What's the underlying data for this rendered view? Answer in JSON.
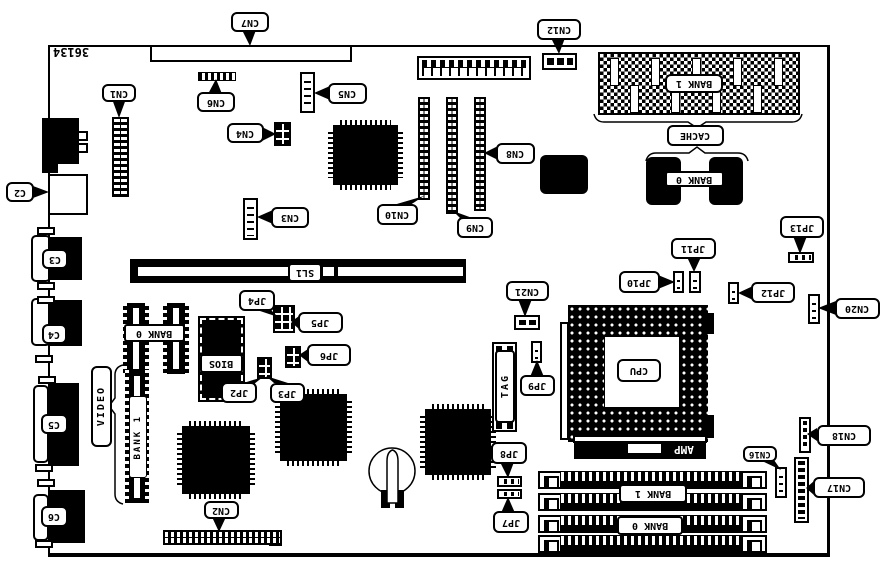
{
  "diagram": {
    "type": "motherboard-layout",
    "part_number": "36134",
    "ink_color": "#000000",
    "background_color": "#ffffff",
    "text_orientation": "rotated-180"
  },
  "labels": {
    "cn1": "CN1",
    "cn2": "CN2",
    "cn3": "CN3",
    "cn4": "CN4",
    "cn5": "CN5",
    "cn6": "CN6",
    "cn7": "CN7",
    "cn8": "CN8",
    "cn9": "CN9",
    "cn10": "CN10",
    "cn12": "CN12",
    "cn16": "CN16",
    "cn17": "CN17",
    "cn18": "CN18",
    "cn20": "CN20",
    "cn21": "CN21",
    "c2": "C2",
    "c3": "C3",
    "c4": "C4",
    "c5": "C5",
    "c6": "C6",
    "jp2": "JP2",
    "jp3": "JP3",
    "jp4": "JP4",
    "jp5": "JP5",
    "jp6": "JP6",
    "jp7": "JP7",
    "jp8": "JP8",
    "jp9": "JP9",
    "jp10": "JP10",
    "jp11": "JP11",
    "jp12": "JP12",
    "jp13": "JP13",
    "cpu": "CPU",
    "sl1": "SL1",
    "bios": "BIOS",
    "tag": "TAG",
    "video": "VIDEO",
    "amp": "AMP",
    "cache": "CACHE",
    "cache_bank1": "BANK 1",
    "cache_bank0": "BANK 0",
    "video_bank0": "BANK 0",
    "video_bank1": "BANK 1",
    "mem_bank1": "BANK 1",
    "mem_bank0": "BANK 0"
  }
}
